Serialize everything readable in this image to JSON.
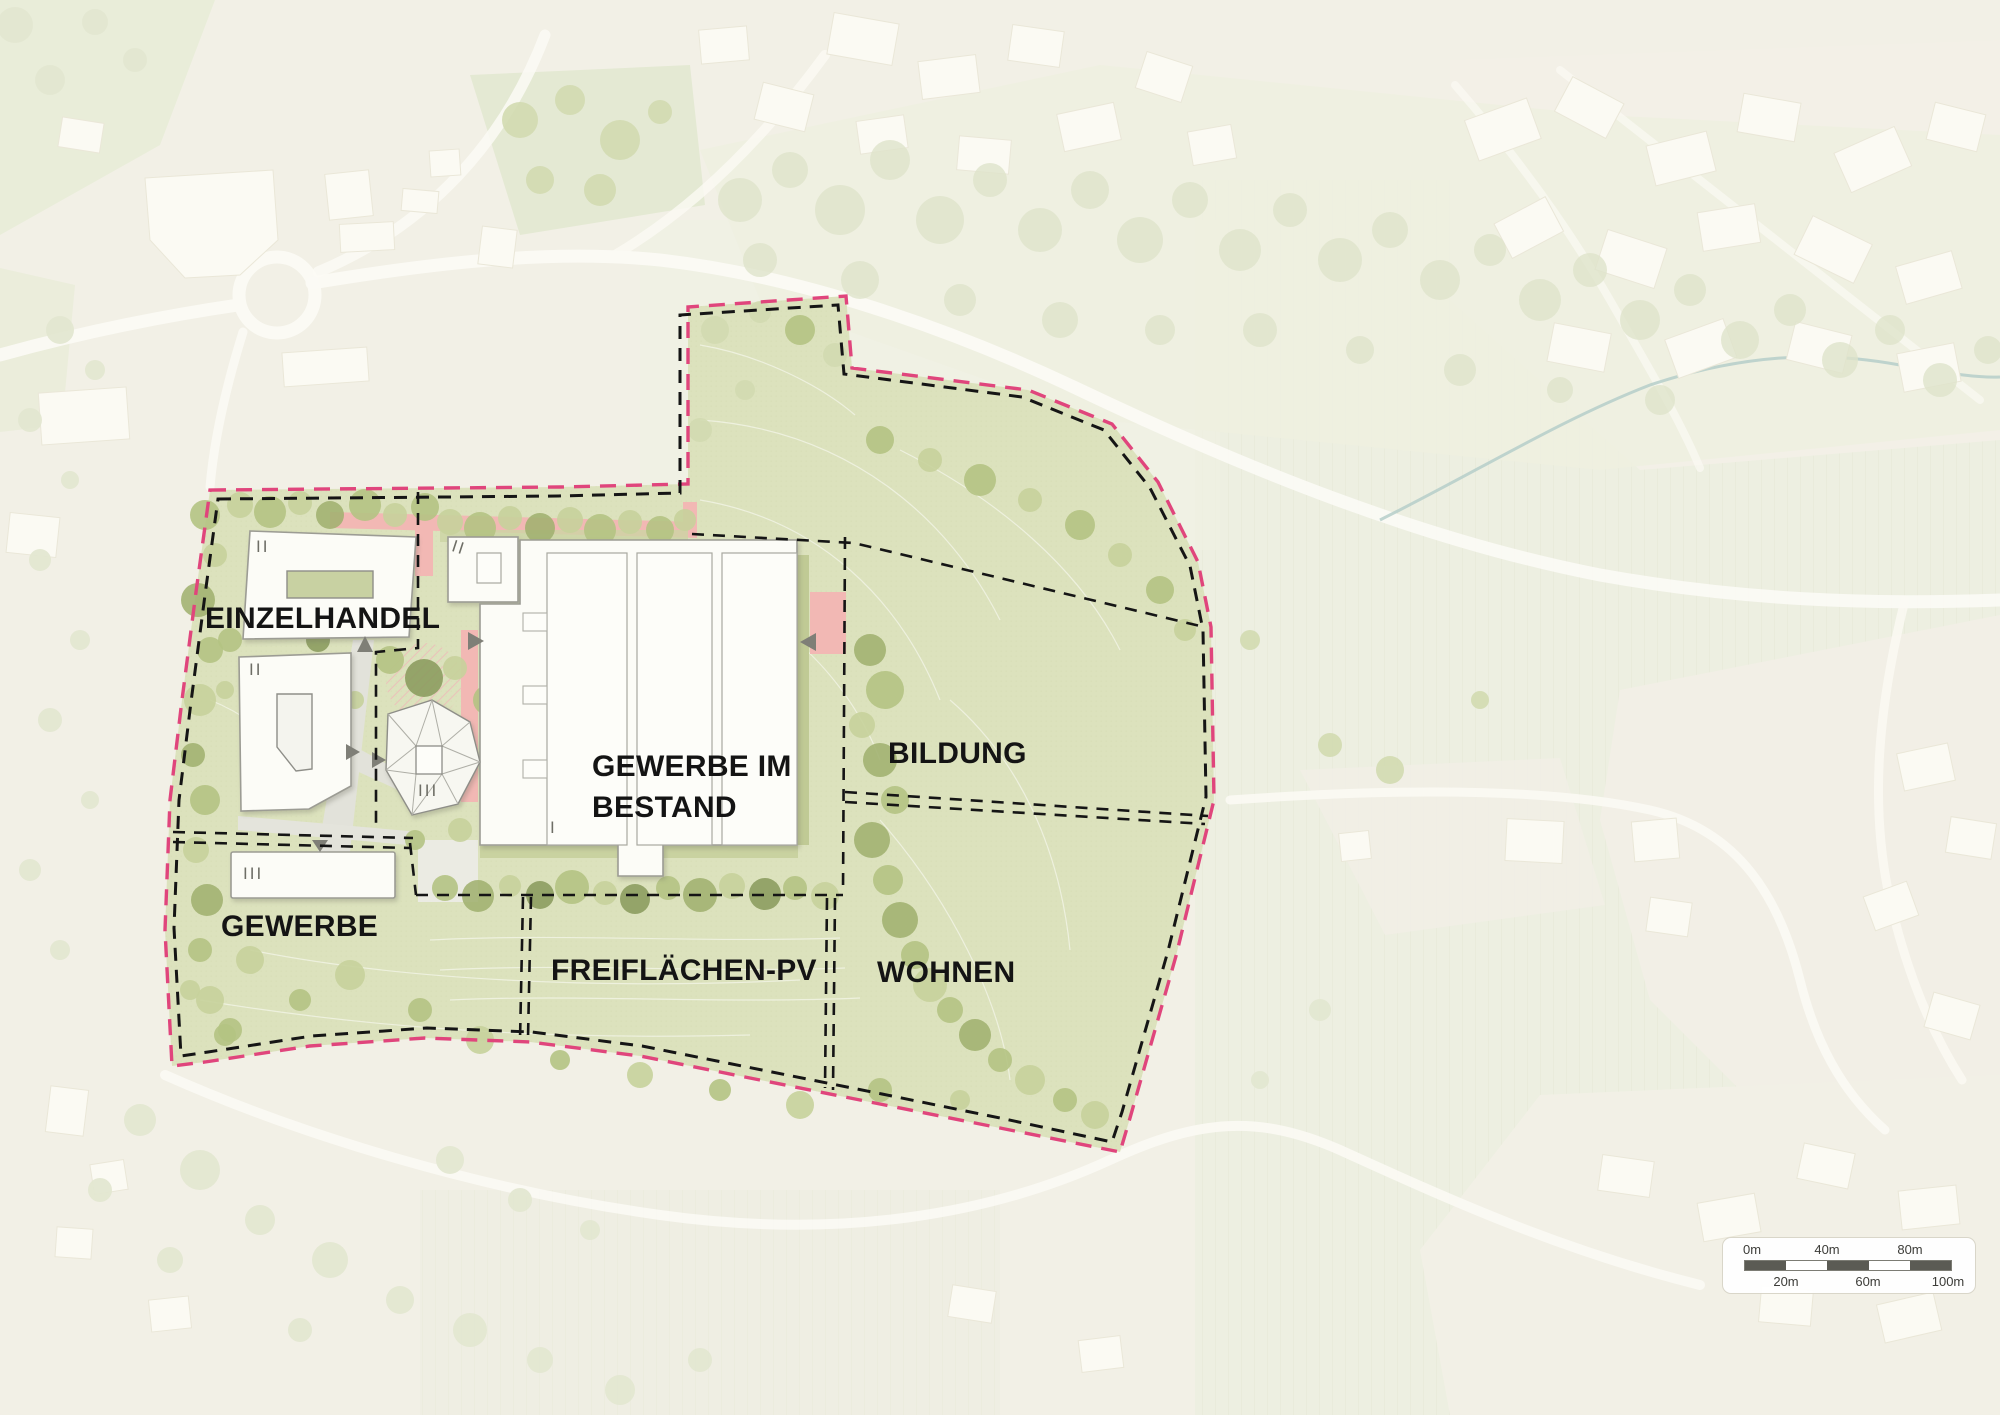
{
  "map": {
    "zones": [
      {
        "id": "einzelhandel",
        "label": "EINZELHANDEL"
      },
      {
        "id": "gewerbe-im-bestand",
        "label": "GEWERBE IM BESTAND",
        "label_lines": [
          "GEWERBE IM",
          "BESTAND"
        ]
      },
      {
        "id": "bildung",
        "label": "BILDUNG"
      },
      {
        "id": "gewerbe",
        "label": "GEWERBE"
      },
      {
        "id": "freiflaechen-pv",
        "label": "FREIFLÄCHEN-PV"
      },
      {
        "id": "wohnen",
        "label": "WOHNEN"
      }
    ],
    "storey_marks": [
      "II",
      "II",
      "III",
      "II",
      "I",
      "III"
    ],
    "scale_bar": {
      "top_labels": [
        "0m",
        "40m",
        "80m"
      ],
      "bottom_labels": [
        "20m",
        "60m",
        "100m"
      ]
    },
    "colors": {
      "site_green": "#dce2bd",
      "boundary_pink": "#e0457c",
      "boundary_black": "#151515",
      "road_pink": "#f2b8b4",
      "building_white": "#fcfcf7",
      "label_black": "#141414",
      "scalebar_dark": "#5b5b54"
    }
  }
}
